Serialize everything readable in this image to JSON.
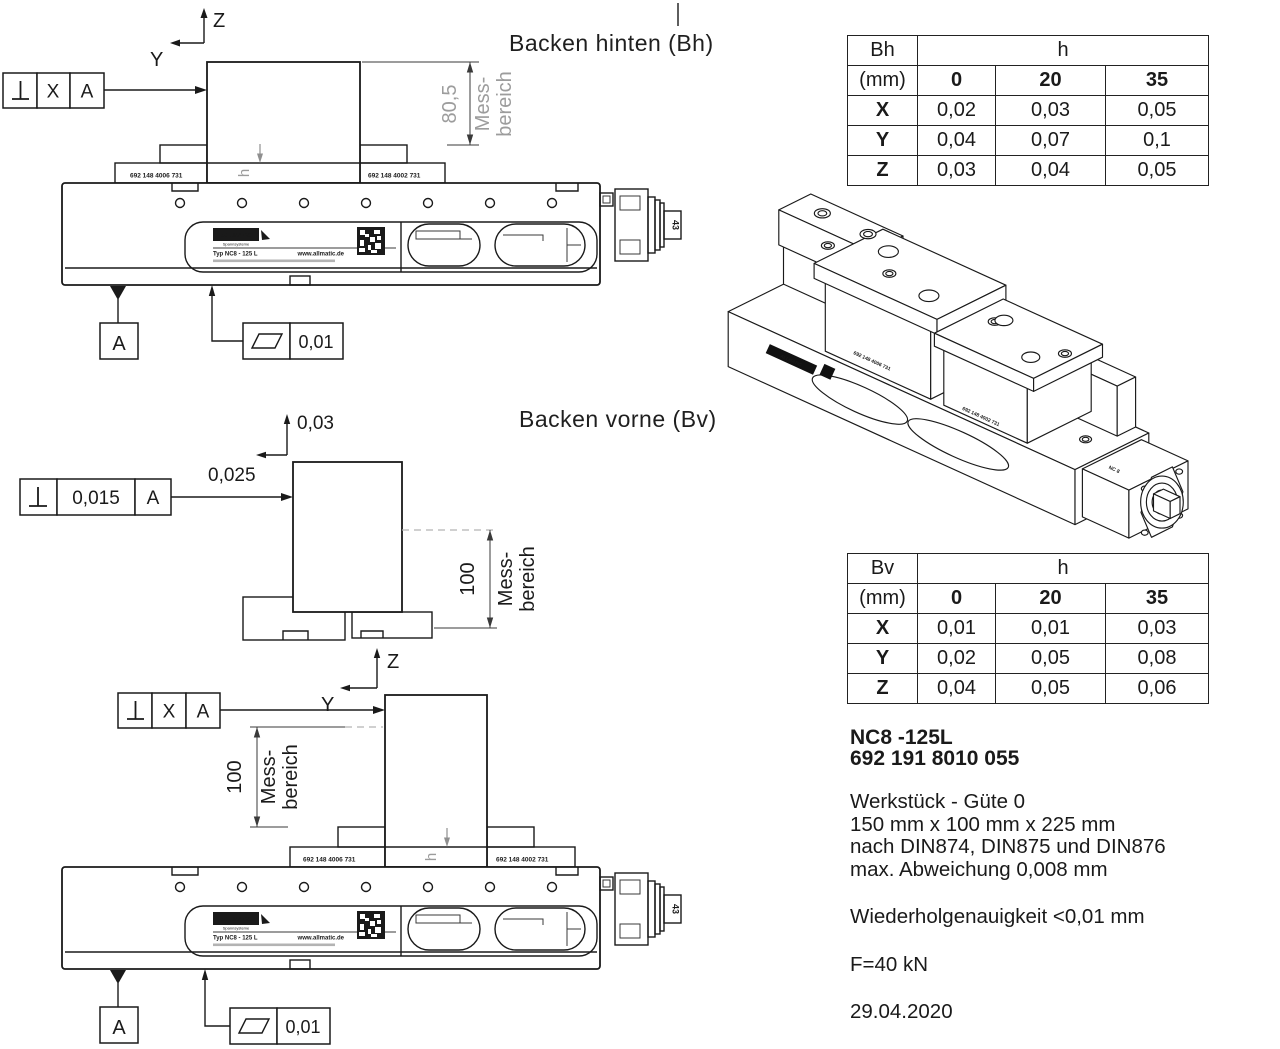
{
  "titles": {
    "rear": "Backen hinten (Bh)",
    "front": "Backen vorne (Bv)"
  },
  "tables": {
    "bh": {
      "corner": "Bh",
      "span": "h",
      "unit": "(mm)",
      "cols": [
        "0",
        "20",
        "35"
      ],
      "rows": [
        {
          "label": "X",
          "values": [
            "0,02",
            "0,03",
            "0,05"
          ]
        },
        {
          "label": "Y",
          "values": [
            "0,04",
            "0,07",
            "0,1"
          ]
        },
        {
          "label": "Z",
          "values": [
            "0,03",
            "0,04",
            "0,05"
          ]
        }
      ]
    },
    "bv": {
      "corner": "Bv",
      "span": "h",
      "unit": "(mm)",
      "cols": [
        "0",
        "20",
        "35"
      ],
      "rows": [
        {
          "label": "X",
          "values": [
            "0,01",
            "0,01",
            "0,03"
          ]
        },
        {
          "label": "Y",
          "values": [
            "0,02",
            "0,05",
            "0,08"
          ]
        },
        {
          "label": "Z",
          "values": [
            "0,04",
            "0,05",
            "0,06"
          ]
        }
      ]
    }
  },
  "info": {
    "model": "NC8 -125L",
    "article": "692 191 8010 055",
    "lines": [
      "Werkstück - Güte 0",
      "150 mm x 100 mm x 225 mm",
      "nach DIN874, DIN875 und DIN876",
      "max. Abweichung 0,008 mm"
    ],
    "repeatability": "Wiederholgenauigkeit <0,01 mm",
    "force": "F=40 kN",
    "date": "29.04.2020"
  },
  "drawing": {
    "axis": {
      "z": "Z",
      "y": "Y"
    },
    "datum": "A",
    "tol_x": "X",
    "flatness_value": "0,01",
    "perp_front_value": "0,015",
    "disp_z": "0,03",
    "disp_y": "0,025",
    "dim_rear": "80,5",
    "dim_front": "100",
    "mess1": "Mess-",
    "mess2": "bereich",
    "h": "h",
    "jaw_left": "692 148 4006 731",
    "jaw_right": "692 148 4002 731",
    "spindle": "43",
    "iso_model": "NC 8",
    "label": {
      "brand": "ALLMATIC",
      "sub": "Spannsysteme",
      "type": "Typ NC8 - 125 L",
      "web": "www.allmatic.de"
    }
  }
}
